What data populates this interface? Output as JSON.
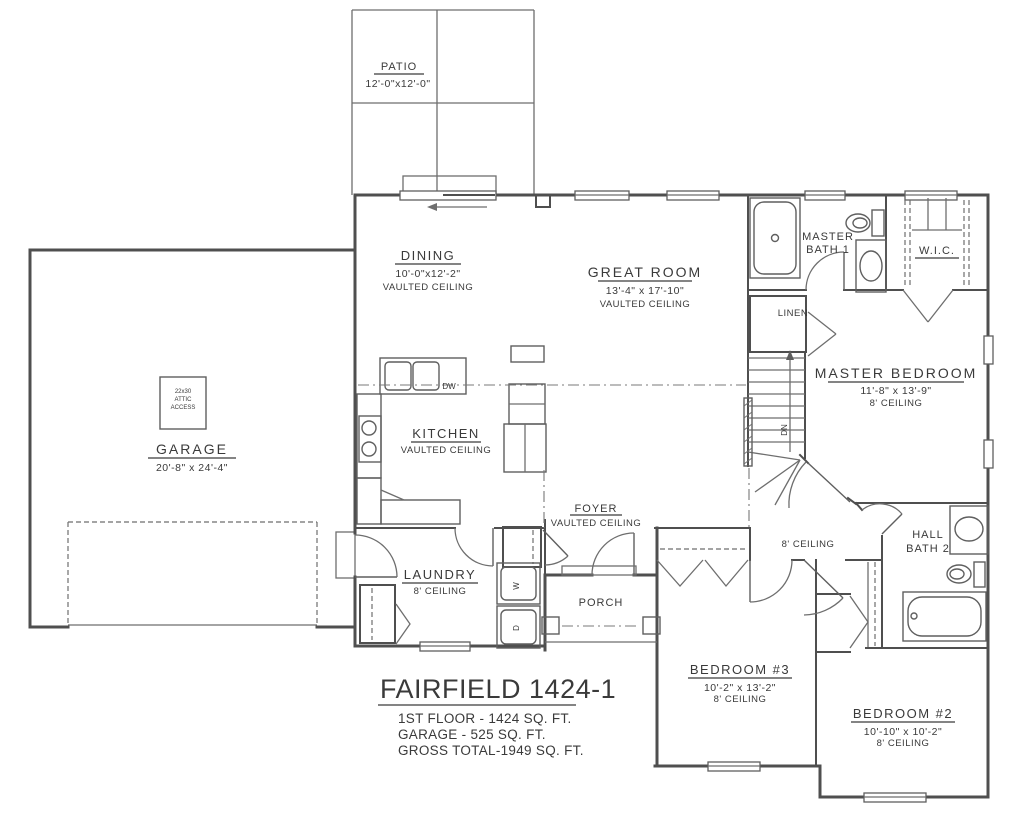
{
  "colors": {
    "wall": "#4f4f4f",
    "text": "#3a3a3a",
    "background": "#ffffff"
  },
  "title_block": {
    "name": "FAIRFIELD 1424-1",
    "lines": [
      "1ST FLOOR - 1424 SQ. FT.",
      "GARAGE - 525 SQ. FT.",
      "GROSS TOTAL-1949 SQ. FT."
    ]
  },
  "rooms": {
    "patio": {
      "name": "PATIO",
      "dims": "12'-0\"x12'-0\""
    },
    "dining": {
      "name": "DINING",
      "dims": "10'-0\"x12'-2\"",
      "ceiling": "VAULTED CEILING"
    },
    "great_room": {
      "name": "GREAT ROOM",
      "dims": "13'-4\" x 17'-10\"",
      "ceiling": "VAULTED CEILING"
    },
    "master_bath": {
      "line1": "MASTER",
      "line2": "BATH 1"
    },
    "wic": {
      "name": "W.I.C."
    },
    "linen": {
      "name": "LINEN"
    },
    "master_bedroom": {
      "name": "MASTER BEDROOM",
      "dims": "11'-8\" x 13'-9\"",
      "ceiling": "8' CEILING"
    },
    "garage": {
      "name": "GARAGE",
      "dims": "20'-8\" x 24'-4\"",
      "attic": [
        "22x30",
        "ATTIC",
        "ACCESS"
      ]
    },
    "kitchen": {
      "name": "KITCHEN",
      "ceiling": "VAULTED CEILING"
    },
    "foyer": {
      "name": "FOYER",
      "ceiling": "VAULTED CEILING"
    },
    "laundry": {
      "name": "LAUNDRY",
      "ceiling": "8' CEILING"
    },
    "porch": {
      "name": "PORCH"
    },
    "hall": {
      "ceiling": "8' CEILING"
    },
    "hall_bath": {
      "line1": "HALL",
      "line2": "BATH 2"
    },
    "bedroom3": {
      "name": "BEDROOM #3",
      "dims": "10'-2\" x 13'-2\"",
      "ceiling": "8' CEILING"
    },
    "bedroom2": {
      "name": "BEDROOM #2",
      "dims": "10'-10\" x 10'-2\"",
      "ceiling": "8' CEILING"
    }
  },
  "annotations": {
    "dw": "DW",
    "dn": "DN",
    "washer": "W",
    "dryer": "D"
  }
}
